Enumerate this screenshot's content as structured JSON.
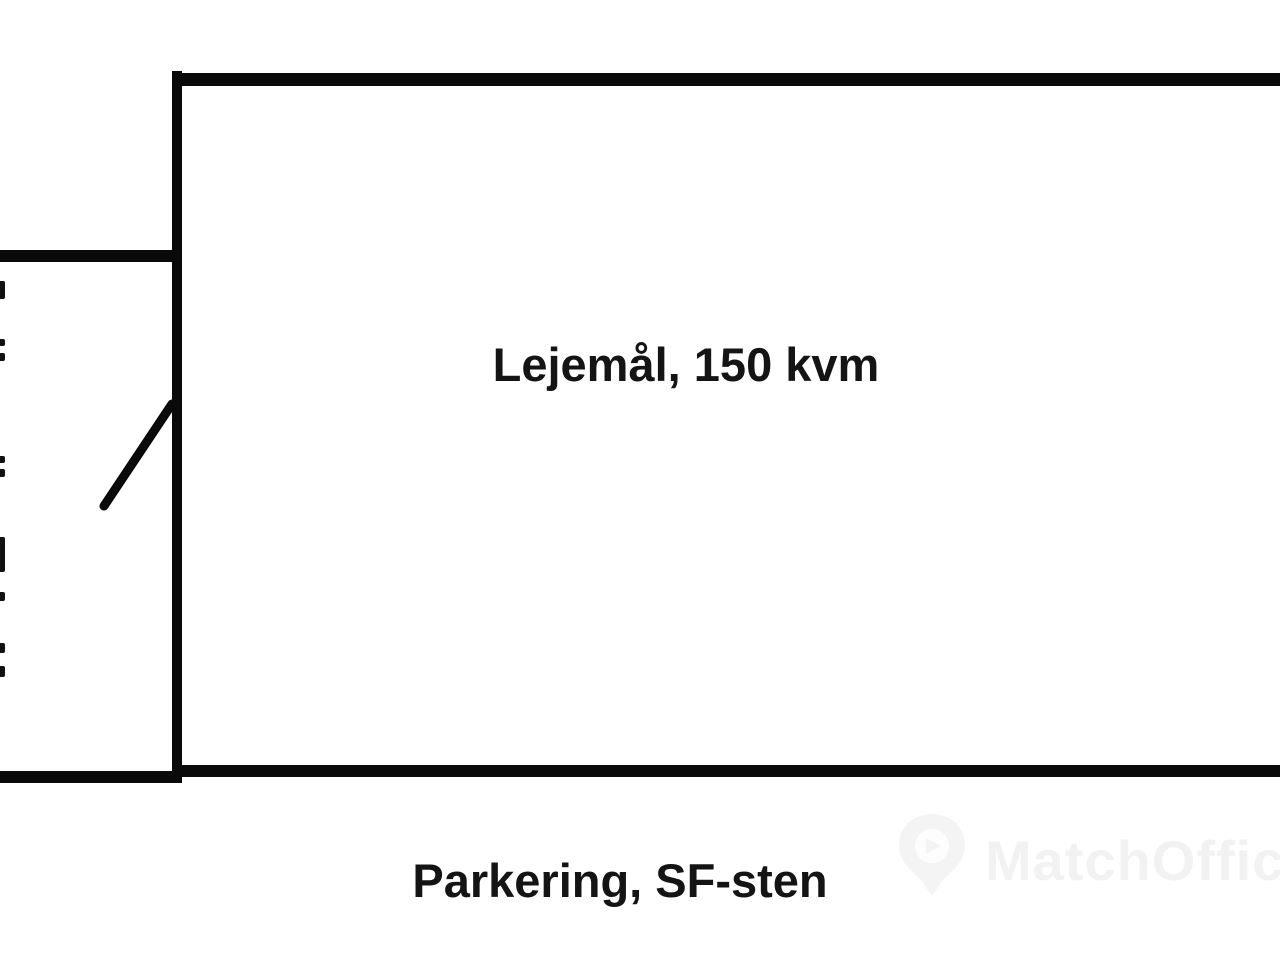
{
  "page": {
    "background_color": "#ffffff",
    "wall_color": "#0a0a0a",
    "text_color": "#141414"
  },
  "floorplan": {
    "unit": {
      "label": "Lejemål, 150 kvm",
      "area_kvm": 150
    },
    "outside": {
      "label": "Parkering, SF-sten"
    },
    "features": [
      "door-swing",
      "left-edge-wall-dashes"
    ]
  },
  "watermark": {
    "brand": "MatchOffice",
    "color": "#f2f2f2",
    "icon": "map-pin-icon"
  }
}
